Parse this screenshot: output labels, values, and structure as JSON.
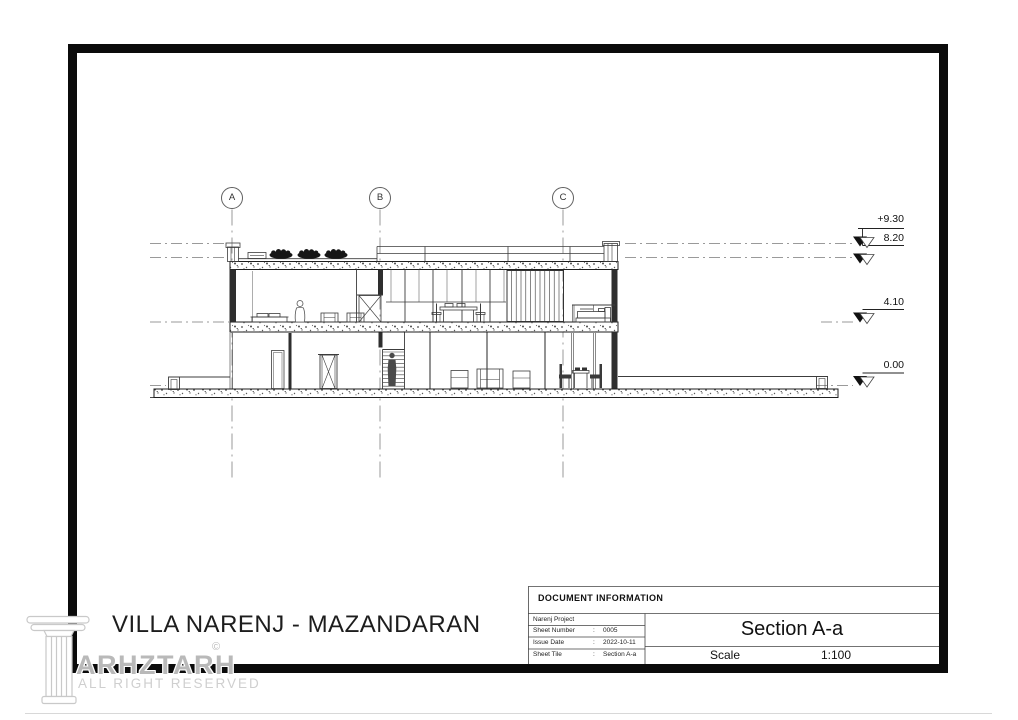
{
  "page": {
    "project_title": "VILLA NARENJ - MAZANDARAN",
    "watermark": {
      "brand": "ARHZTARH",
      "copyright": "©",
      "tagline": "ALL RIGHT RESERVED"
    },
    "drawing": {
      "grid_bubbles": [
        "A",
        "B",
        "C"
      ],
      "elevation_labels": [
        "+9.30",
        "8.20",
        "4.10",
        "0.00"
      ]
    },
    "title_block": {
      "header": "DOCUMENT INFORMATION",
      "rows": [
        {
          "label": "Narenj Project",
          "sep": "",
          "value": ""
        },
        {
          "label": "Sheet Number",
          "sep": ":",
          "value": "0005"
        },
        {
          "label": "Issue Date",
          "sep": ":",
          "value": "2022-10-11"
        },
        {
          "label": "Sheet Tile",
          "sep": ":",
          "value": "Section A-a"
        }
      ],
      "sheet_title": "Section A-a",
      "scale_label": "Scale",
      "scale_value": "1:100"
    }
  }
}
